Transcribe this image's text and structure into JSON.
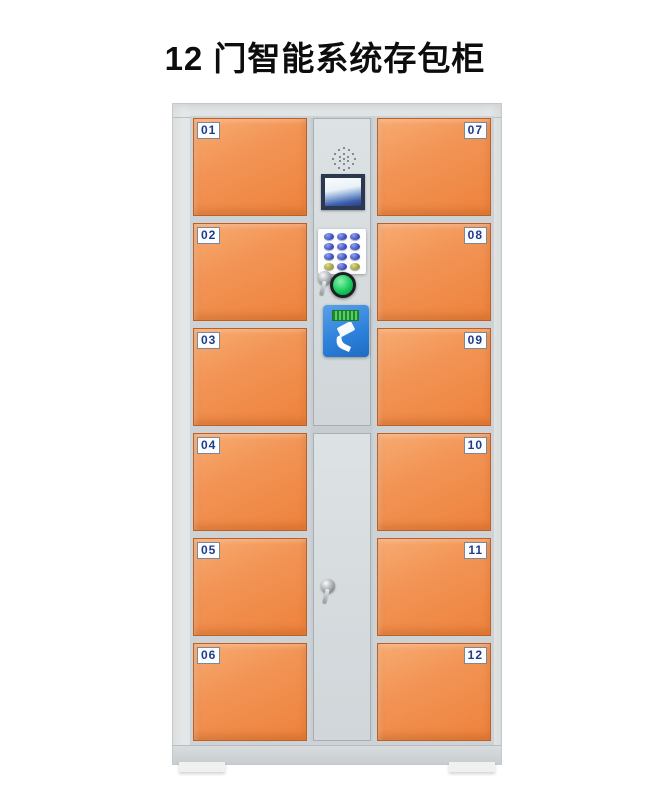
{
  "page": {
    "title": "12 门智能系统存包柜"
  },
  "doors": {
    "left": [
      "01",
      "02",
      "03",
      "04",
      "05",
      "06"
    ],
    "right": [
      "07",
      "08",
      "09",
      "10",
      "11",
      "12"
    ]
  },
  "control_panel": {
    "icons": {
      "speaker": "speaker-grill-dots",
      "display": "lcd-display-screen",
      "keypad": "12-key-numeric-keypad",
      "upper_lock": "key-lock-with-key",
      "confirm_button": "green-round-push-button",
      "card_reader": "blue-rfid-card-reader",
      "reader_display": "mini-green-lcd",
      "lower_lock": "key-lock-with-key"
    }
  },
  "colors": {
    "door_orange": "#F08A46",
    "door_orange_light": "#F7A265",
    "door_border": "#C05F1F",
    "cabinet_gray": "#E2E6E7",
    "panel_gray": "#D2D8DA",
    "label_text": "#1F3C8C",
    "button_green": "#18C95D",
    "reader_blue": "#2E82DC",
    "lcd_frame": "#2C3850"
  }
}
